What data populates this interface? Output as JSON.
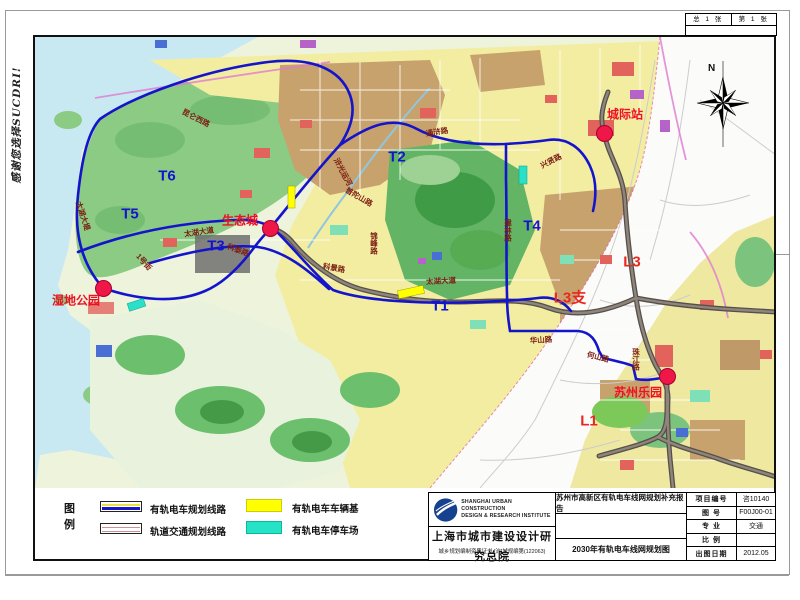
{
  "page": {
    "side_note": "感谢您选择SUCDRI!",
    "sheet_no": {
      "total": "总  1  张",
      "current": "第  1  张"
    }
  },
  "map": {
    "compass_label": "N",
    "stations": [
      {
        "name": "城际站",
        "x": 604,
        "y": 133,
        "lx": 625,
        "ly": 114
      },
      {
        "name": "生态城",
        "x": 270,
        "y": 228,
        "lx": 240,
        "ly": 220
      },
      {
        "name": "湿地公园",
        "x": 103,
        "y": 288,
        "lx": 76,
        "ly": 300
      },
      {
        "name": "苏州乐园",
        "x": 667,
        "y": 376,
        "lx": 638,
        "ly": 392
      }
    ],
    "line_labels": [
      {
        "text": "T6",
        "x": 167,
        "y": 176,
        "c": "blue"
      },
      {
        "text": "T5",
        "x": 130,
        "y": 214,
        "c": "blue"
      },
      {
        "text": "T3",
        "x": 216,
        "y": 246,
        "c": "blue"
      },
      {
        "text": "T2",
        "x": 397,
        "y": 157,
        "c": "blue"
      },
      {
        "text": "T1",
        "x": 440,
        "y": 306,
        "c": "blue"
      },
      {
        "text": "T4",
        "x": 532,
        "y": 226,
        "c": "blue"
      },
      {
        "text": "L3",
        "x": 632,
        "y": 262,
        "c": "red"
      },
      {
        "text": "L3支",
        "x": 570,
        "y": 297,
        "c": "red"
      },
      {
        "text": "L1",
        "x": 589,
        "y": 421,
        "c": "red"
      }
    ],
    "road_labels": [
      {
        "text": "昆仑西路",
        "x": 196,
        "y": 118,
        "rot": 27
      },
      {
        "text": "太湖大堤",
        "x": 83,
        "y": 216,
        "rot": 72
      },
      {
        "text": "太湖大道",
        "x": 199,
        "y": 232,
        "rot": -8
      },
      {
        "text": "太湖大道",
        "x": 441,
        "y": 281,
        "rot": -3
      },
      {
        "text": "1号街",
        "x": 144,
        "y": 262,
        "rot": 48
      },
      {
        "text": "科泰路",
        "x": 238,
        "y": 250,
        "rot": 20
      },
      {
        "text": "科景路",
        "x": 334,
        "y": 268,
        "rot": 10
      },
      {
        "text": "普陀山路",
        "x": 359,
        "y": 197,
        "rot": 30
      },
      {
        "text": "浒光运河",
        "x": 343,
        "y": 172,
        "rot": 62
      },
      {
        "text": "锦峰路",
        "x": 374,
        "y": 243,
        "vert": true
      },
      {
        "text": "通浒路",
        "x": 437,
        "y": 132,
        "rot": -9
      },
      {
        "text": "兴贤路",
        "x": 551,
        "y": 161,
        "rot": -27
      },
      {
        "text": "建林路",
        "x": 508,
        "y": 230,
        "vert": true
      },
      {
        "text": "华山路",
        "x": 541,
        "y": 340,
        "rot": -4
      },
      {
        "text": "何山路",
        "x": 598,
        "y": 357,
        "rot": 14
      },
      {
        "text": "珠江路",
        "x": 636,
        "y": 359,
        "vert": true
      }
    ]
  },
  "legend": {
    "title": "图例",
    "items": [
      {
        "label": "有轨电车规划线路",
        "type": "tram"
      },
      {
        "label": "轨道交通规划线路",
        "type": "rail"
      },
      {
        "label": "有轨电车车辆基",
        "type": "depot"
      },
      {
        "label": "有轨电车停车场",
        "type": "parking"
      }
    ]
  },
  "title_block": {
    "institute_en1": "SHANGHAI URBAN CONSTRUCTION",
    "institute_en2": "DESIGN & RESEARCH INSTITUTE",
    "institute_cn": "上海市城市建设设计研究总院",
    "credential": "城乡规划编制资质证书:[沪]城规编第(122063)",
    "report_title": "苏州市高新区有轨电车线网规划补充报告",
    "drawing_title": "2030年有轨电车线网规划图",
    "fields": [
      {
        "label": "项目编号",
        "value": "咨10140"
      },
      {
        "label": "图  号",
        "value": "F00J00-01"
      },
      {
        "label": "专  业",
        "value": "交通"
      },
      {
        "label": "比  例",
        "value": ""
      },
      {
        "label": "出图日期",
        "value": "2012.05"
      }
    ]
  },
  "colors": {
    "tram_line": "#1414cc",
    "rail_line": "#6e655e",
    "marker": "#ee1748",
    "depot": "#ffff00",
    "parking": "#2ae0c8",
    "water": "#c9e9f2"
  }
}
